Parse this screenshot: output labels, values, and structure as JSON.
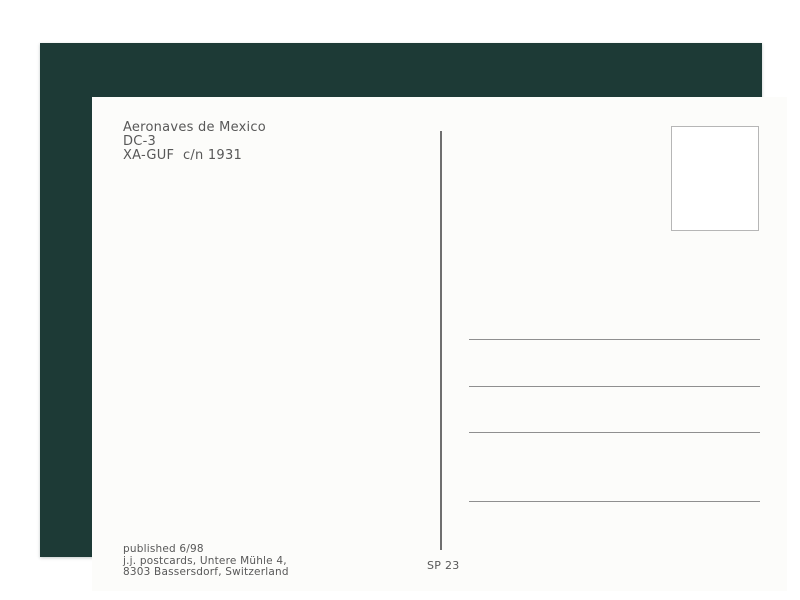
{
  "postcard": {
    "caption": {
      "airline": "Aeronaves de Mexico",
      "aircraft_type": "DC-3",
      "registration": "XA-GUF  c/n 1931"
    },
    "publisher": {
      "published_line": "published 6/98",
      "name_line": "j.j. postcards, Untere Mühle 4,",
      "city_line": "8303 Bassersdorf, Switzerland"
    },
    "series_number": "SP 23",
    "address_area": {
      "line_count": 4
    },
    "icons": {
      "stamp_box": "empty stamp placement box"
    },
    "colors": {
      "frame_green": "#1d3a36",
      "card_white": "#fcfcfa",
      "text_gray": "#585858",
      "rule_gray": "#8f8f8f",
      "divider_gray": "#6f6f6f",
      "stamp_border": "#b6b6b6"
    }
  }
}
